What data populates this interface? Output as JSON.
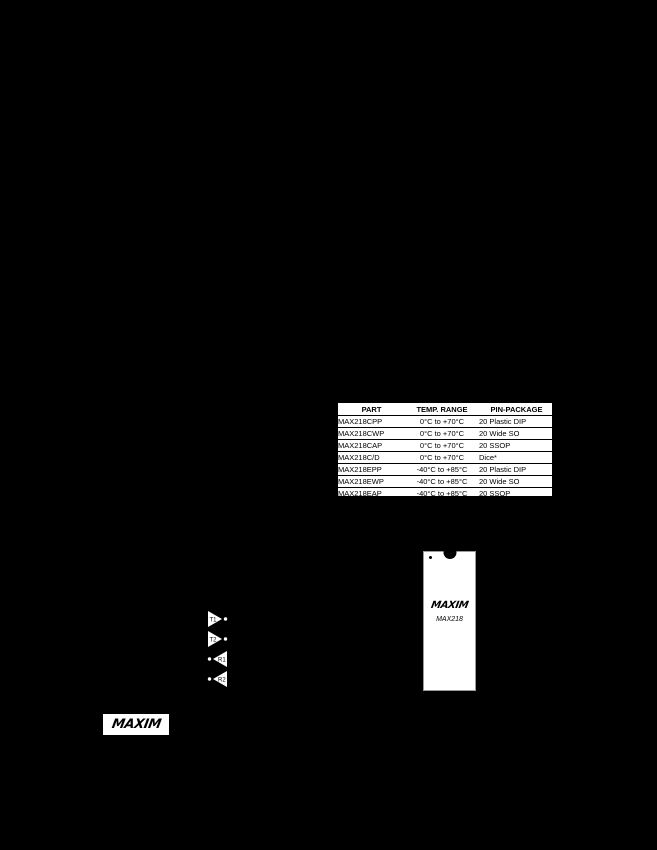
{
  "page": {
    "background_color": "#000000",
    "surface_color": "#ffffff",
    "text_color": "#000000"
  },
  "ordering_table": {
    "headers": [
      "PART",
      "TEMP. RANGE",
      "PIN-PACKAGE"
    ],
    "rows": [
      [
        "MAX218CPP",
        "0°C to +70°C",
        "20 Plastic DIP"
      ],
      [
        "MAX218CWP",
        "0°C to +70°C",
        "20 Wide SO"
      ],
      [
        "MAX218CAP",
        "0°C to +70°C",
        "20 SSOP"
      ],
      [
        "MAX218C/D",
        "0°C to +70°C",
        "Dice*"
      ],
      [
        "MAX218EPP",
        "-40°C to +85°C",
        "20 Plastic DIP"
      ],
      [
        "MAX218EWP",
        "-40°C to +85°C",
        "20 Wide SO"
      ],
      [
        "MAX218EAP",
        "-40°C to +85°C",
        "20 SSOP"
      ]
    ]
  },
  "buffers": [
    {
      "label": "T1",
      "direction": "right"
    },
    {
      "label": "T2",
      "direction": "right"
    },
    {
      "label": "R1",
      "direction": "left"
    },
    {
      "label": "R2",
      "direction": "left"
    }
  ],
  "package_diagram": {
    "brand": "MAXIM",
    "part": "MAX218"
  },
  "footer": {
    "brand": "MAXIM"
  }
}
